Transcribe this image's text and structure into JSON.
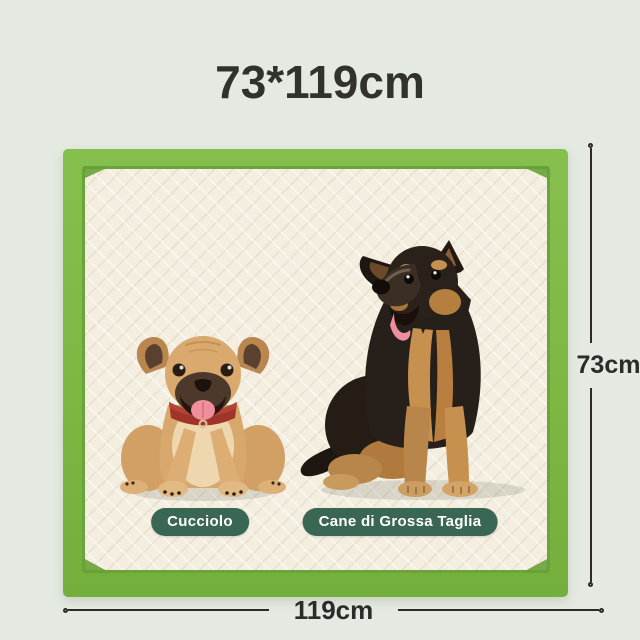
{
  "title": "73*119cm",
  "pad": {
    "height_label": "73cm",
    "width_label": "119cm"
  },
  "badges": [
    {
      "label": "Cucciolo"
    },
    {
      "label": "Cane di Grossa Taglia"
    }
  ],
  "colors": {
    "background": "#e4eae1",
    "pad_border_green": "#7db843",
    "pad_border_dark_green": "#68a136",
    "pad_surface_cream": "#f3eee0",
    "badge_green": "#3a6753",
    "badge_text": "#ffffff",
    "dimension_line": "#2b2b28",
    "title_text": "#32322d",
    "puppy_coat_tan": "#d7a76b",
    "puppy_collar_red": "#a03428",
    "large_dog_black": "#241c15",
    "large_dog_tan": "#c6914f",
    "tongue_pink": "#ef8f9b"
  },
  "icons": {
    "puppy": "puppy-illustration",
    "large_dog": "large-dog-illustration"
  }
}
